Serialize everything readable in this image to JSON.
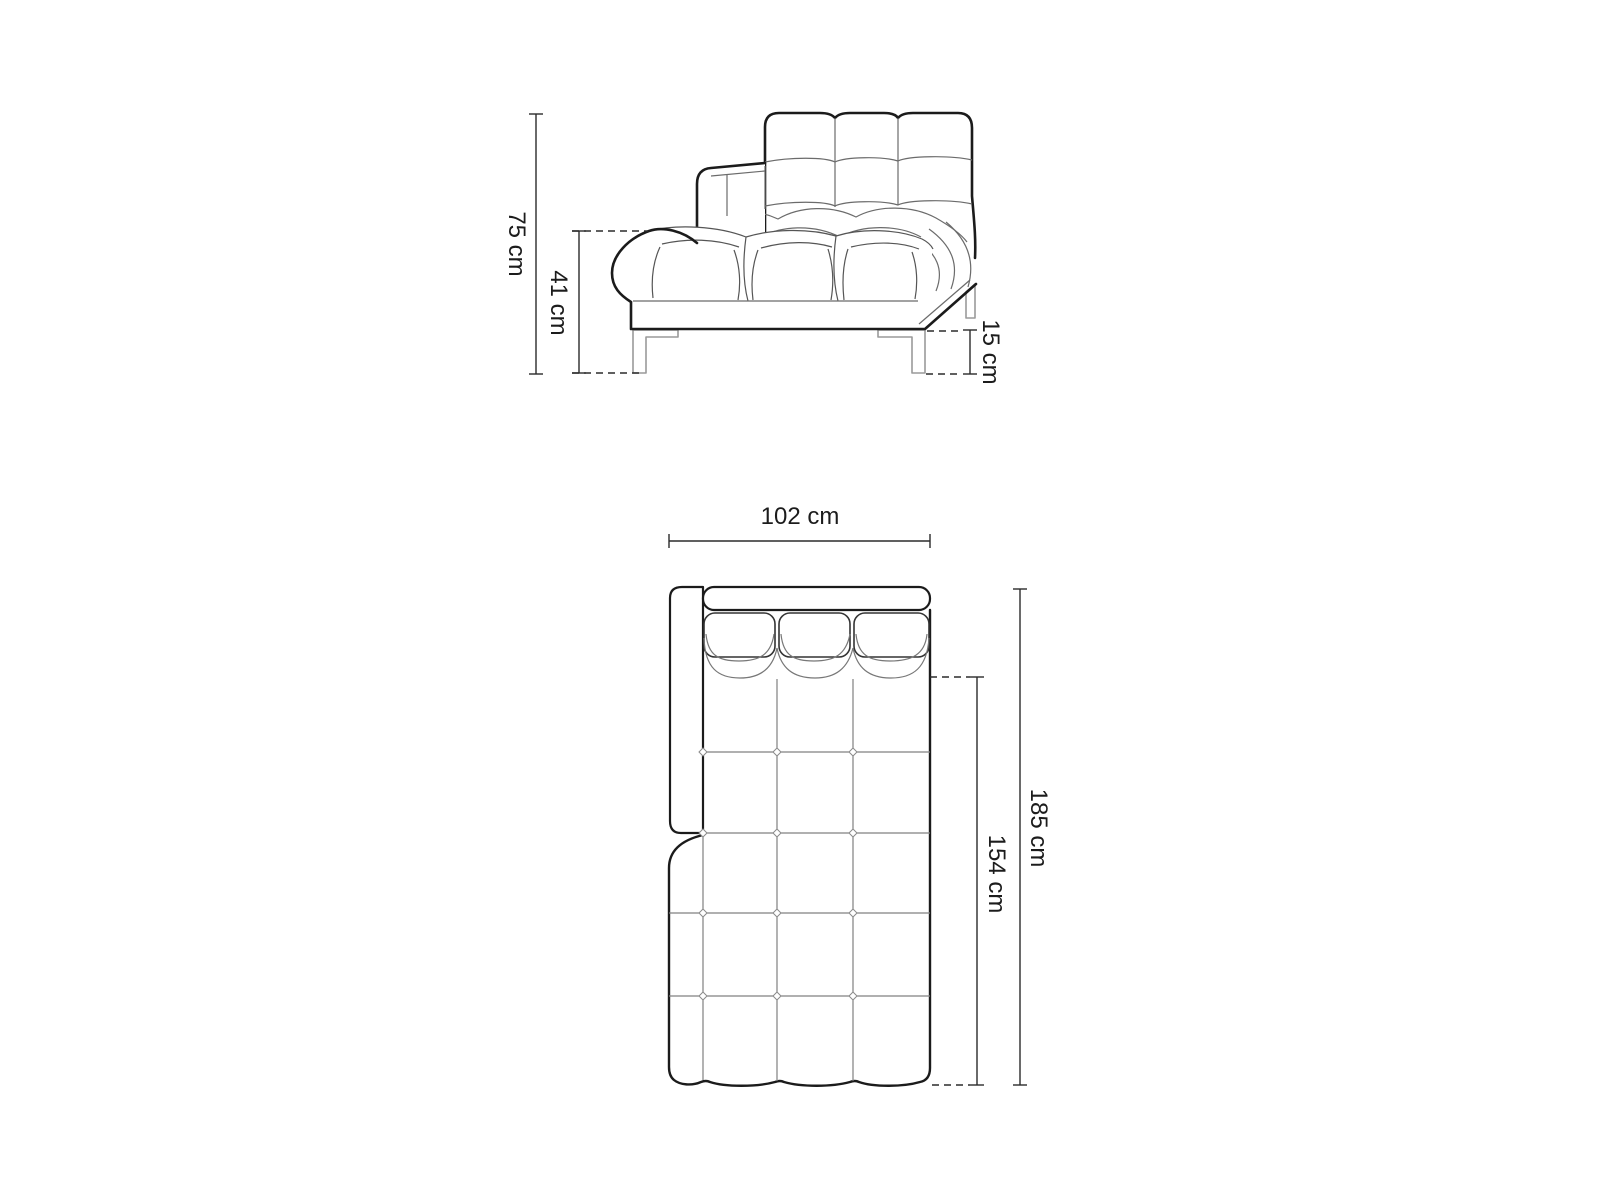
{
  "side_view": {
    "dim_total_height": "75 cm",
    "dim_seat_height": "41 cm",
    "dim_leg_height": "15 cm"
  },
  "top_view": {
    "dim_width": "102 cm",
    "dim_total_depth": "185 cm",
    "dim_seat_depth": "154 cm"
  },
  "colors": {
    "outline": "#1b1b1b",
    "seam": "#6b6b6b",
    "leg": "#9a9a9a",
    "dimension": "#2b2b2b",
    "background": "#ffffff"
  }
}
